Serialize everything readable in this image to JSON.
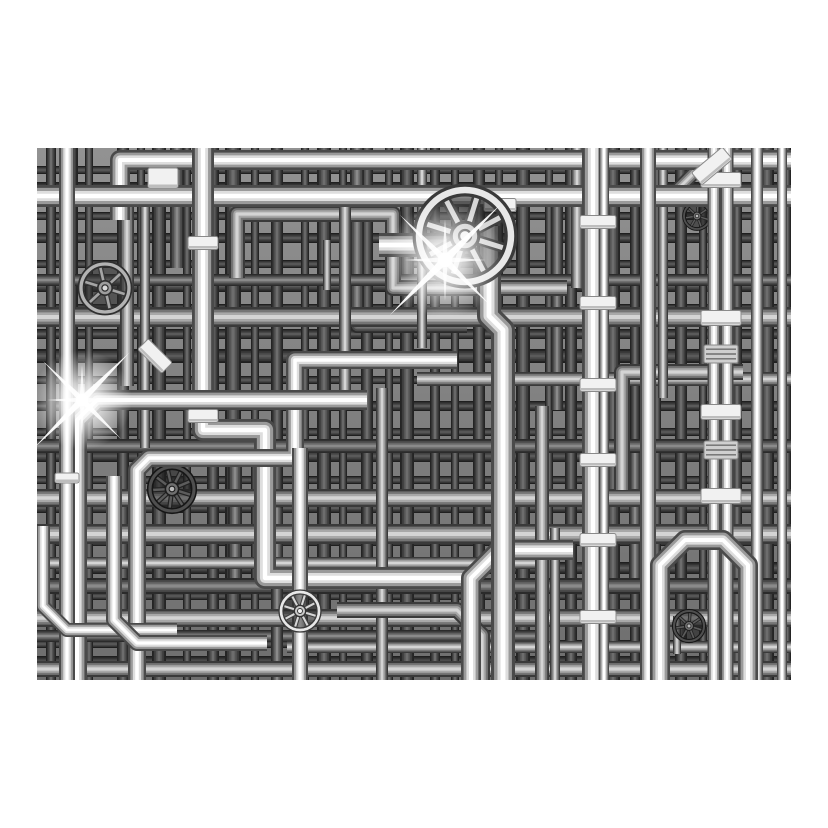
{
  "meta": {
    "description": "Black and white 3D render of a dense industrial maze of chrome plumbing pipes with valve handwheels, clamp bands and lens flares, centered on a white background",
    "page_background": "#ffffff"
  },
  "frame": {
    "left": 37,
    "top": 148,
    "width": 754,
    "height": 532
  },
  "palette": {
    "base_top": "#929292",
    "base_bottom": "#6e6e6e",
    "flare_white": "#ffffff",
    "clamp_fill": "#f1f1f1",
    "clamp_edge": "#8a8a8a"
  },
  "scene": {
    "shade_sets": {
      "backdrop_v": [
        "#242424",
        "#3d3d3d",
        "#555555",
        "#6d6d6d"
      ],
      "backdrop_h": [
        "#1f1f1f",
        "#353535",
        "#484848",
        "#5a5a5a"
      ],
      "deep": [
        "#2b2b2b",
        "#4a4a4a",
        "#686868",
        "#8a8a8a"
      ],
      "mid": [
        "#3a3a3a",
        "#757575",
        "#a8a8a8",
        "#d4d4d4"
      ],
      "chrome": [
        "#4a4a4a",
        "#9a9a9a",
        "#dedede",
        "#ffffff"
      ]
    },
    "backdrop": {
      "verticals": [
        {
          "x": 14,
          "w": 10
        },
        {
          "x": 34,
          "w": 14
        },
        {
          "x": 52,
          "w": 8
        },
        {
          "x": 86,
          "w": 12
        },
        {
          "x": 104,
          "w": 8
        },
        {
          "x": 122,
          "w": 14
        },
        {
          "x": 150,
          "w": 8
        },
        {
          "x": 176,
          "w": 12
        },
        {
          "x": 196,
          "w": 16
        },
        {
          "x": 218,
          "w": 8
        },
        {
          "x": 240,
          "w": 12
        },
        {
          "x": 268,
          "w": 8
        },
        {
          "x": 287,
          "w": 14
        },
        {
          "x": 306,
          "w": 8
        },
        {
          "x": 330,
          "w": 12
        },
        {
          "x": 352,
          "w": 8
        },
        {
          "x": 370,
          "w": 14
        },
        {
          "x": 398,
          "w": 10
        },
        {
          "x": 418,
          "w": 8
        },
        {
          "x": 442,
          "w": 12
        },
        {
          "x": 462,
          "w": 8
        },
        {
          "x": 486,
          "w": 14
        },
        {
          "x": 512,
          "w": 8
        },
        {
          "x": 534,
          "w": 12
        },
        {
          "x": 552,
          "w": 8
        },
        {
          "x": 576,
          "w": 14
        },
        {
          "x": 598,
          "w": 10
        },
        {
          "x": 620,
          "w": 8
        },
        {
          "x": 644,
          "w": 12
        },
        {
          "x": 666,
          "w": 8
        },
        {
          "x": 700,
          "w": 10
        },
        {
          "x": 730,
          "w": 14
        },
        {
          "x": 750,
          "w": 8
        }
      ],
      "horizontals": [
        {
          "y": 22,
          "w": 8
        },
        {
          "y": 40,
          "w": 12
        },
        {
          "y": 68,
          "w": 8
        },
        {
          "y": 90,
          "w": 10
        },
        {
          "y": 116,
          "w": 8
        },
        {
          "y": 138,
          "w": 12
        },
        {
          "y": 160,
          "w": 8
        },
        {
          "y": 186,
          "w": 10
        },
        {
          "y": 208,
          "w": 14
        },
        {
          "y": 232,
          "w": 8
        },
        {
          "y": 258,
          "w": 10
        },
        {
          "y": 284,
          "w": 8
        },
        {
          "y": 308,
          "w": 12
        },
        {
          "y": 332,
          "w": 8
        },
        {
          "y": 360,
          "w": 10
        },
        {
          "y": 394,
          "w": 8
        },
        {
          "y": 420,
          "w": 12
        },
        {
          "y": 448,
          "w": 8
        },
        {
          "y": 474,
          "w": 10
        },
        {
          "y": 496,
          "w": 8
        },
        {
          "y": 514,
          "w": 12
        }
      ]
    },
    "deep_pipes": [
      {
        "w": 14,
        "pts": [
          [
            140,
            -10
          ],
          [
            140,
            120
          ]
        ]
      },
      {
        "w": 14,
        "pts": [
          [
            320,
            -10
          ],
          [
            320,
            178
          ],
          [
            430,
            178
          ]
        ]
      },
      {
        "w": 12,
        "pts": [
          [
            520,
            56
          ],
          [
            520,
            262
          ]
        ]
      },
      {
        "w": 14,
        "pts": [
          [
            60,
            298
          ],
          [
            198,
            298
          ],
          [
            198,
            432
          ]
        ]
      },
      {
        "w": 12,
        "pts": [
          [
            598,
            298
          ],
          [
            598,
            438
          ],
          [
            700,
            438
          ]
        ]
      },
      {
        "w": 12,
        "pts": [
          [
            -10,
            132
          ],
          [
            764,
            132
          ]
        ]
      },
      {
        "w": 14,
        "pts": [
          [
            -10,
            298
          ],
          [
            764,
            298
          ]
        ]
      },
      {
        "w": 16,
        "pts": [
          [
            -10,
            438
          ],
          [
            764,
            438
          ]
        ]
      },
      {
        "w": 12,
        "pts": [
          [
            -10,
            488
          ],
          [
            500,
            488
          ]
        ]
      },
      {
        "w": 12,
        "pts": [
          [
            240,
            360
          ],
          [
            240,
            540
          ]
        ]
      }
    ],
    "mid_pipes": [
      {
        "w": 20,
        "pts": [
          [
            -10,
            169
          ],
          [
            764,
            169
          ]
        ]
      },
      {
        "w": 14,
        "pts": [
          [
            380,
            231
          ],
          [
            764,
            231
          ]
        ]
      },
      {
        "w": 18,
        "pts": [
          [
            -10,
            350
          ],
          [
            764,
            350
          ]
        ]
      },
      {
        "w": 20,
        "pts": [
          [
            -10,
            386
          ],
          [
            764,
            386
          ]
        ]
      },
      {
        "w": 12,
        "pts": [
          [
            -10,
            415
          ],
          [
            500,
            415
          ]
        ]
      },
      {
        "w": 18,
        "pts": [
          [
            -10,
            470
          ],
          [
            764,
            470
          ]
        ]
      },
      {
        "w": 12,
        "pts": [
          [
            250,
            499
          ],
          [
            764,
            499
          ]
        ]
      },
      {
        "w": 16,
        "pts": [
          [
            -10,
            521
          ],
          [
            764,
            521
          ]
        ]
      },
      {
        "w": 16,
        "pts": [
          [
            200,
            130
          ],
          [
            200,
            66
          ],
          [
            356,
            66
          ],
          [
            356,
            140
          ],
          [
            530,
            140
          ]
        ]
      },
      {
        "w": 14,
        "pts": [
          [
            90,
            48
          ],
          [
            90,
            238
          ]
        ]
      },
      {
        "w": 10,
        "pts": [
          [
            108,
            48
          ],
          [
            108,
            300
          ]
        ]
      },
      {
        "w": 12,
        "pts": [
          [
            308,
            40
          ],
          [
            308,
            250
          ]
        ]
      },
      {
        "w": 12,
        "pts": [
          [
            345,
            240
          ],
          [
            345,
            540
          ]
        ]
      },
      {
        "w": 10,
        "pts": [
          [
            385,
            -10
          ],
          [
            385,
            200
          ]
        ]
      },
      {
        "w": 14,
        "pts": [
          [
            505,
            258
          ],
          [
            505,
            540
          ]
        ]
      },
      {
        "w": 12,
        "pts": [
          [
            540,
            -10
          ],
          [
            540,
            140
          ]
        ]
      },
      {
        "w": 14,
        "pts": [
          [
            640,
            42
          ],
          [
            674,
            8
          ]
        ]
      },
      {
        "w": 16,
        "pts": [
          [
            585,
            342
          ],
          [
            585,
            224
          ],
          [
            706,
            224
          ]
        ]
      },
      {
        "w": 16,
        "pts": [
          [
            300,
            462
          ],
          [
            420,
            462
          ],
          [
            445,
            487
          ],
          [
            445,
            540
          ]
        ]
      },
      {
        "w": 8,
        "pts": [
          [
            290,
            92
          ],
          [
            290,
            142
          ]
        ]
      },
      {
        "w": 8,
        "pts": [
          [
            470,
            348
          ],
          [
            470,
            388
          ]
        ]
      },
      {
        "w": 8,
        "pts": [
          [
            640,
            468
          ],
          [
            640,
            506
          ]
        ]
      },
      {
        "w": 10,
        "pts": [
          [
            626,
            -10
          ],
          [
            626,
            250
          ]
        ]
      },
      {
        "w": 10,
        "pts": [
          [
            518,
            380
          ],
          [
            518,
            540
          ]
        ]
      }
    ],
    "chrome_pipes": [
      {
        "w": 20,
        "pts": [
          [
            83,
            72
          ],
          [
            83,
            12
          ],
          [
            764,
            12
          ]
        ]
      },
      {
        "w": 22,
        "pts": [
          [
            -10,
            48
          ],
          [
            764,
            48
          ]
        ]
      },
      {
        "w": 22,
        "pts": [
          [
            166,
            -12
          ],
          [
            166,
            282
          ],
          [
            228,
            282
          ],
          [
            228,
            430
          ],
          [
            436,
            430
          ]
        ]
      },
      {
        "w": 18,
        "pts": [
          [
            100,
            544
          ],
          [
            100,
            322
          ],
          [
            112,
            310
          ],
          [
            258,
            310
          ],
          [
            258,
            212
          ],
          [
            420,
            212
          ]
        ]
      },
      {
        "w": 20,
        "pts": [
          [
            40,
            544
          ],
          [
            40,
            272
          ],
          [
            60,
            252
          ],
          [
            330,
            252
          ]
        ]
      },
      {
        "w": 16,
        "pts": [
          [
            30,
            -12
          ],
          [
            30,
            544
          ]
        ]
      },
      {
        "w": 14,
        "pts": [
          [
            6,
            378
          ],
          [
            6,
            458
          ],
          [
            30,
            482
          ],
          [
            140,
            482
          ]
        ]
      },
      {
        "w": 16,
        "pts": [
          [
            77,
            328
          ],
          [
            77,
            472
          ],
          [
            100,
            495
          ],
          [
            230,
            495
          ]
        ]
      },
      {
        "w": 16,
        "pts": [
          [
            263,
            544
          ],
          [
            263,
            300
          ]
        ]
      },
      {
        "w": 20,
        "pts": [
          [
            536,
            402
          ],
          [
            462,
            402
          ],
          [
            434,
            430
          ],
          [
            434,
            544
          ]
        ]
      },
      {
        "w": 24,
        "pts": [
          [
            342,
            97
          ],
          [
            452,
            97
          ]
        ]
      },
      {
        "w": 24,
        "pts": [
          [
            452,
            78
          ],
          [
            452,
            168
          ],
          [
            466,
            182
          ],
          [
            466,
            544
          ]
        ]
      },
      {
        "w": 22,
        "pts": [
          [
            556,
            -12
          ],
          [
            556,
            544
          ]
        ]
      },
      {
        "w": 10,
        "pts": [
          [
            567,
            -12
          ],
          [
            567,
            544
          ]
        ]
      },
      {
        "w": 16,
        "pts": [
          [
            611,
            -12
          ],
          [
            611,
            544
          ]
        ]
      },
      {
        "w": 13,
        "pts": [
          [
            677,
            -12
          ],
          [
            677,
            544
          ]
        ]
      },
      {
        "w": 13,
        "pts": [
          [
            690,
            -12
          ],
          [
            690,
            544
          ]
        ]
      },
      {
        "w": 12,
        "pts": [
          [
            720,
            -12
          ],
          [
            720,
            544
          ]
        ]
      },
      {
        "w": 10,
        "pts": [
          [
            745,
            -12
          ],
          [
            745,
            544
          ]
        ]
      },
      {
        "w": 20,
        "pts": [
          [
            623,
            548
          ],
          [
            623,
            417
          ],
          [
            648,
            392
          ],
          [
            686,
            392
          ],
          [
            711,
            417
          ],
          [
            711,
            548
          ]
        ]
      }
    ],
    "clamps": [
      {
        "x": 166,
        "y": 95,
        "w": 30,
        "h": 13,
        "angle": 0,
        "tone": "band"
      },
      {
        "x": 166,
        "y": 268,
        "w": 30,
        "h": 13,
        "angle": 0,
        "tone": "band"
      },
      {
        "x": 463,
        "y": 57,
        "w": 32,
        "h": 13,
        "angle": 0,
        "tone": "band"
      },
      {
        "x": 561,
        "y": 74,
        "w": 36,
        "h": 13,
        "angle": 0,
        "tone": "band"
      },
      {
        "x": 561,
        "y": 155,
        "w": 36,
        "h": 13,
        "angle": 0,
        "tone": "band"
      },
      {
        "x": 561,
        "y": 237,
        "w": 36,
        "h": 13,
        "angle": 0,
        "tone": "band"
      },
      {
        "x": 561,
        "y": 312,
        "w": 36,
        "h": 13,
        "angle": 0,
        "tone": "band"
      },
      {
        "x": 561,
        "y": 392,
        "w": 36,
        "h": 13,
        "angle": 0,
        "tone": "band"
      },
      {
        "x": 561,
        "y": 469,
        "w": 36,
        "h": 13,
        "angle": 0,
        "tone": "band"
      },
      {
        "x": 684,
        "y": 32,
        "w": 40,
        "h": 15,
        "angle": 0,
        "tone": "band"
      },
      {
        "x": 684,
        "y": 170,
        "w": 40,
        "h": 15,
        "angle": 0,
        "tone": "band"
      },
      {
        "x": 684,
        "y": 264,
        "w": 40,
        "h": 15,
        "angle": 0,
        "tone": "band"
      },
      {
        "x": 684,
        "y": 348,
        "w": 40,
        "h": 15,
        "angle": 0,
        "tone": "band"
      },
      {
        "x": 684,
        "y": 206,
        "w": 34,
        "h": 18,
        "angle": 0,
        "tone": "rib"
      },
      {
        "x": 684,
        "y": 302,
        "w": 34,
        "h": 18,
        "angle": 0,
        "tone": "rib"
      },
      {
        "x": 126,
        "y": 30,
        "w": 30,
        "h": 20,
        "angle": 0,
        "tone": "band"
      },
      {
        "x": 118,
        "y": 208,
        "w": 34,
        "h": 15,
        "angle": 45,
        "tone": "band"
      },
      {
        "x": 675,
        "y": 18,
        "w": 40,
        "h": 16,
        "angle": -40,
        "tone": "band"
      },
      {
        "x": 30,
        "y": 330,
        "w": 24,
        "h": 10,
        "angle": 0,
        "tone": "band"
      }
    ],
    "mid_valves": [
      {
        "cx": 68,
        "cy": 140,
        "r": 24,
        "tone": "mid",
        "spokes": 6
      },
      {
        "cx": 660,
        "cy": 68,
        "r": 13,
        "tone": "dark",
        "spokes": 7
      },
      {
        "cx": 135,
        "cy": 341,
        "r": 22,
        "tone": "dark",
        "spokes": 9
      },
      {
        "cx": 652,
        "cy": 478,
        "r": 15,
        "tone": "dark",
        "spokes": 7
      }
    ],
    "chrome_valves": [
      {
        "cx": 428,
        "cy": 88,
        "r": 46,
        "tone": "bright",
        "spokes": 8
      },
      {
        "cx": 263,
        "cy": 463,
        "r": 19,
        "tone": "bright",
        "spokes": 8
      }
    ],
    "flares": [
      {
        "cx": 408,
        "cy": 112,
        "r": 58
      },
      {
        "cx": 45,
        "cy": 252,
        "r": 50
      }
    ]
  }
}
